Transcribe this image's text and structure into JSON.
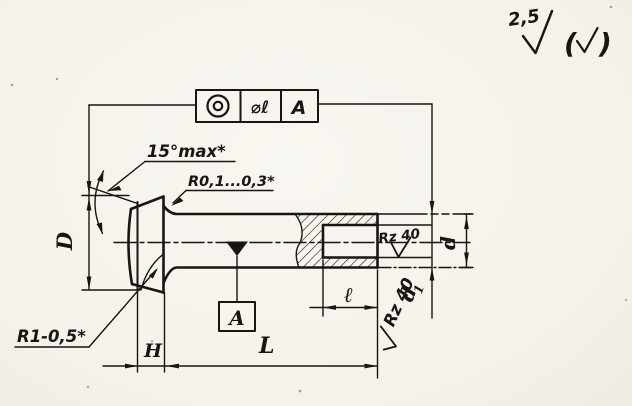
{
  "surface_finish": {
    "general_value": "2,5",
    "paren_open": "(",
    "paren_close": ")"
  },
  "tolerance_frame": {
    "symbol": "concentricity",
    "tolerance": "⌀ℓ",
    "datum_ref": "A"
  },
  "callouts": {
    "head_angle": "15°max*",
    "junction_fillet": "R0,1...0,3*",
    "edge_radius": "R1-0,5*"
  },
  "roughness": {
    "bore": "Rz 40",
    "end_face": "Rz 40"
  },
  "dimensions": {
    "head_diameter": "D",
    "head_thickness": "H",
    "total_length": "L",
    "bore_depth": "ℓ",
    "shank_diameter": "d",
    "bore_diameter_base": "d",
    "bore_diameter_index": "1"
  },
  "datum": {
    "label": "A"
  },
  "colors": {
    "ink": "#181512",
    "paper": "#f6f4ee"
  }
}
